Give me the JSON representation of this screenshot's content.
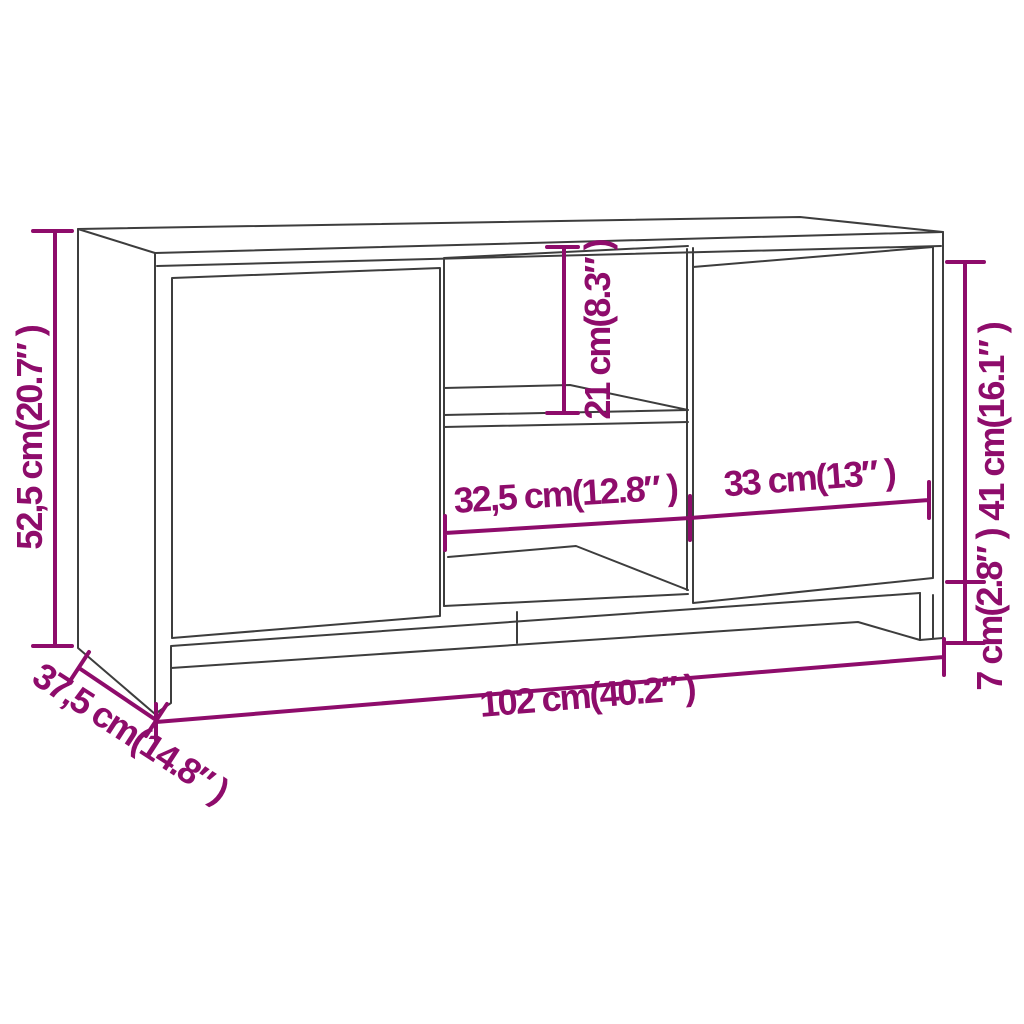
{
  "diagram": {
    "subject": "TV cabinet line drawing with dimension annotations",
    "colors": {
      "dimension": "#8E0C6B",
      "outline": "#3D3D3D",
      "background": "#FFFFFF"
    },
    "dimensions": {
      "overall_height": "52,5 cm(20.7″ )",
      "depth": "37,5 cm(14.8″ )",
      "overall_width": "102 cm(40.2″ )",
      "open_compartment_height": "21 cm(8.3″ )",
      "open_compartment_width": "32,5 cm(12.8″ )",
      "door_width": "33 cm(13″ )",
      "door_height": "41 cm(16.1″ )",
      "base_height": "7 cm(2.8″ )"
    }
  }
}
